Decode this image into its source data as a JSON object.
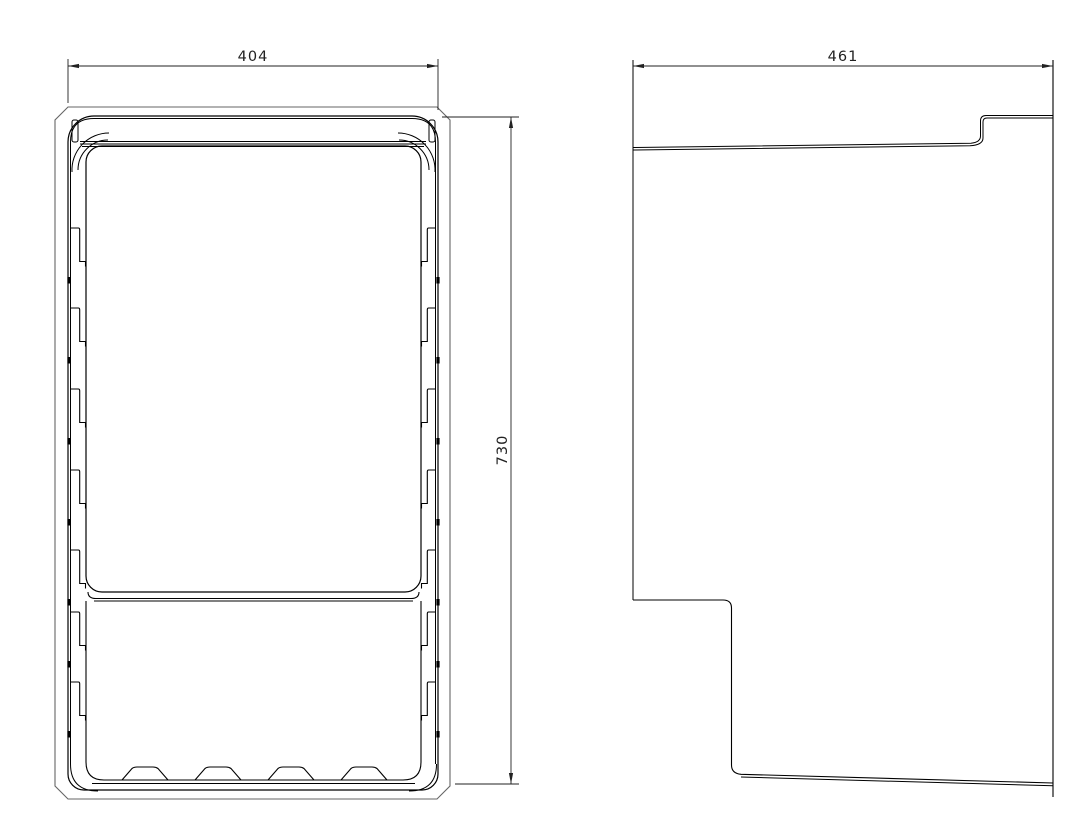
{
  "drawing": {
    "kind": "2d-engineering-drawing",
    "background_color": "#ffffff",
    "line_color": "#000000",
    "outer_shell_color": "#666666",
    "dimension_color": "#222222",
    "views": [
      {
        "id": "front-view",
        "description": "front elevation of cabinet liner with shelf notches and bottom ribs"
      },
      {
        "id": "side-view",
        "description": "side profile with stepped top edge and stepped bottom recess"
      }
    ],
    "dimensions": [
      {
        "id": "dim-width",
        "value": "404",
        "orientation": "horizontal",
        "view": "front-view"
      },
      {
        "id": "dim-height",
        "value": "730",
        "orientation": "vertical",
        "view": "front-view"
      },
      {
        "id": "dim-depth",
        "value": "461",
        "orientation": "horizontal",
        "view": "side-view"
      }
    ]
  }
}
